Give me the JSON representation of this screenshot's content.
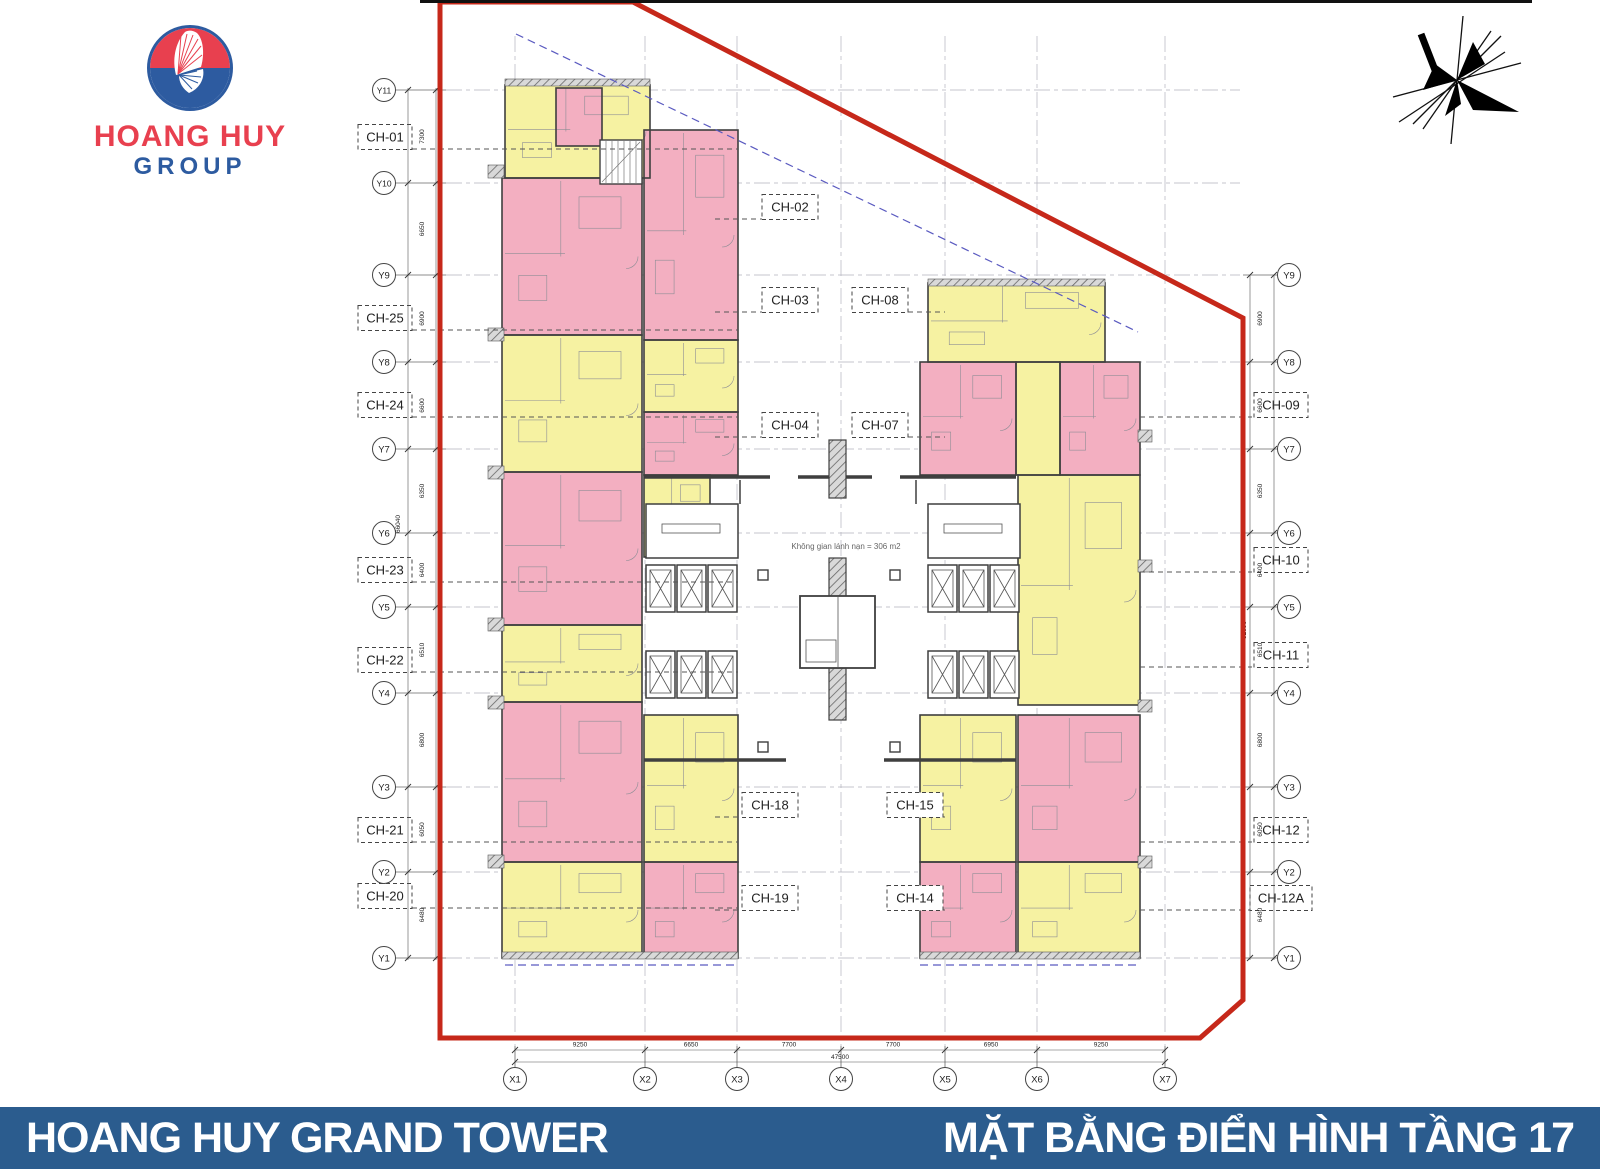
{
  "logo": {
    "line1": "HOANG HUY",
    "line2": "GROUP"
  },
  "footer": {
    "left": "HOANG HUY GRAND TOWER",
    "right": "MẶT BẰNG ĐIỂN HÌNH TẦNG 17"
  },
  "colors": {
    "pink": "#f3afc1",
    "yellow": "#f6f2a2",
    "wall": "#3f3f3f",
    "boundary_red": "#c6281a",
    "footer_blue": "#2b5c8e",
    "grid": "#b4b4bf",
    "leader": "#555555",
    "setback_blue": "#5a5ac0",
    "logo_red": "#e8404f",
    "logo_blue": "#2d5ba0"
  },
  "plan": {
    "refuge_text": "Không gian lánh nạn = 306 m2",
    "boundary": [
      [
        440,
        2
      ],
      [
        633,
        2
      ],
      [
        1243,
        318
      ],
      [
        1243,
        1000
      ],
      [
        1200,
        1038
      ],
      [
        440,
        1038
      ],
      [
        440,
        2
      ]
    ],
    "setback": [
      [
        516,
        34
      ],
      [
        1138,
        332
      ]
    ],
    "axes": {
      "left_y": [
        {
          "id": "Y11",
          "y": 90
        },
        {
          "id": "Y10",
          "y": 183
        },
        {
          "id": "Y9",
          "y": 275
        },
        {
          "id": "Y8",
          "y": 362
        },
        {
          "id": "Y7",
          "y": 449
        },
        {
          "id": "Y6",
          "y": 533
        },
        {
          "id": "Y5",
          "y": 607
        },
        {
          "id": "Y4",
          "y": 693
        },
        {
          "id": "Y3",
          "y": 787
        },
        {
          "id": "Y2",
          "y": 872
        },
        {
          "id": "Y1",
          "y": 958
        }
      ],
      "right_y": [
        {
          "id": "Y9",
          "y": 275
        },
        {
          "id": "Y8",
          "y": 362
        },
        {
          "id": "Y7",
          "y": 449
        },
        {
          "id": "Y6",
          "y": 533
        },
        {
          "id": "Y5",
          "y": 607
        },
        {
          "id": "Y4",
          "y": 693
        },
        {
          "id": "Y3",
          "y": 787
        },
        {
          "id": "Y2",
          "y": 872
        },
        {
          "id": "Y1",
          "y": 958
        }
      ],
      "x": [
        {
          "id": "X1",
          "x": 515
        },
        {
          "id": "X2",
          "x": 645
        },
        {
          "id": "X3",
          "x": 737
        },
        {
          "id": "X4",
          "x": 841
        },
        {
          "id": "X5",
          "x": 945
        },
        {
          "id": "X6",
          "x": 1037
        },
        {
          "id": "X7",
          "x": 1165
        }
      ]
    },
    "dims": {
      "left": {
        "values": [
          "7300",
          "6650",
          "6900",
          "6600",
          "6350",
          "6400",
          "6510",
          "6800",
          "6050",
          "6480"
        ],
        "total": "66040"
      },
      "right": {
        "values": [
          "6900",
          "6600",
          "6350",
          "6400",
          "6510",
          "6800",
          "6050",
          "6480"
        ],
        "total": "52090"
      },
      "bottom": {
        "values": [
          "9250",
          "6650",
          "7700",
          "7700",
          "6950",
          "9250"
        ],
        "total": "47500"
      }
    },
    "unit_labels": {
      "left": [
        {
          "id": "CH-01",
          "y": 137
        },
        {
          "id": "CH-25",
          "y": 318
        },
        {
          "id": "CH-24",
          "y": 405
        },
        {
          "id": "CH-23",
          "y": 570
        },
        {
          "id": "CH-22",
          "y": 660
        },
        {
          "id": "CH-21",
          "y": 830
        },
        {
          "id": "CH-20",
          "y": 896
        }
      ],
      "right": [
        {
          "id": "CH-09",
          "y": 405
        },
        {
          "id": "CH-10",
          "y": 560
        },
        {
          "id": "CH-11",
          "y": 655
        },
        {
          "id": "CH-12",
          "y": 830
        },
        {
          "id": "CH-12A",
          "y": 898
        }
      ],
      "middle": [
        {
          "id": "CH-02",
          "x": 790,
          "y": 207,
          "dir": "left"
        },
        {
          "id": "CH-03",
          "x": 790,
          "y": 300,
          "dir": "left"
        },
        {
          "id": "CH-08",
          "x": 880,
          "y": 300,
          "dir": "right"
        },
        {
          "id": "CH-04",
          "x": 790,
          "y": 425,
          "dir": "left"
        },
        {
          "id": "CH-07",
          "x": 880,
          "y": 425,
          "dir": "right"
        },
        {
          "id": "CH-18",
          "x": 770,
          "y": 805,
          "dir": "left"
        },
        {
          "id": "CH-15",
          "x": 915,
          "y": 805,
          "dir": "right"
        },
        {
          "id": "CH-19",
          "x": 770,
          "y": 898,
          "dir": "left"
        },
        {
          "id": "CH-14",
          "x": 915,
          "y": 898,
          "dir": "right"
        }
      ]
    },
    "units": [
      [
        505,
        85,
        145,
        93,
        "y"
      ],
      [
        556,
        88,
        46,
        58,
        "p"
      ],
      [
        502,
        178,
        140,
        157,
        "p"
      ],
      [
        502,
        335,
        140,
        137,
        "y"
      ],
      [
        502,
        472,
        140,
        153,
        "p"
      ],
      [
        502,
        625,
        140,
        77,
        "y"
      ],
      [
        502,
        702,
        140,
        160,
        "p"
      ],
      [
        502,
        862,
        140,
        96,
        "y"
      ],
      [
        644,
        130,
        94,
        210,
        "p"
      ],
      [
        644,
        340,
        94,
        72,
        "y"
      ],
      [
        644,
        412,
        94,
        63,
        "p"
      ],
      [
        644,
        475,
        66,
        82,
        "y"
      ],
      [
        644,
        715,
        94,
        147,
        "y"
      ],
      [
        644,
        862,
        94,
        96,
        "p"
      ],
      [
        928,
        283,
        177,
        79,
        "y"
      ],
      [
        920,
        362,
        96,
        113,
        "p"
      ],
      [
        1016,
        362,
        44,
        113,
        "y"
      ],
      [
        1060,
        362,
        80,
        113,
        "p"
      ],
      [
        1018,
        475,
        122,
        230,
        "y"
      ],
      [
        920,
        715,
        96,
        147,
        "y"
      ],
      [
        920,
        862,
        96,
        96,
        "p"
      ],
      [
        1018,
        715,
        122,
        147,
        "p"
      ],
      [
        1018,
        862,
        122,
        96,
        "y"
      ]
    ]
  }
}
